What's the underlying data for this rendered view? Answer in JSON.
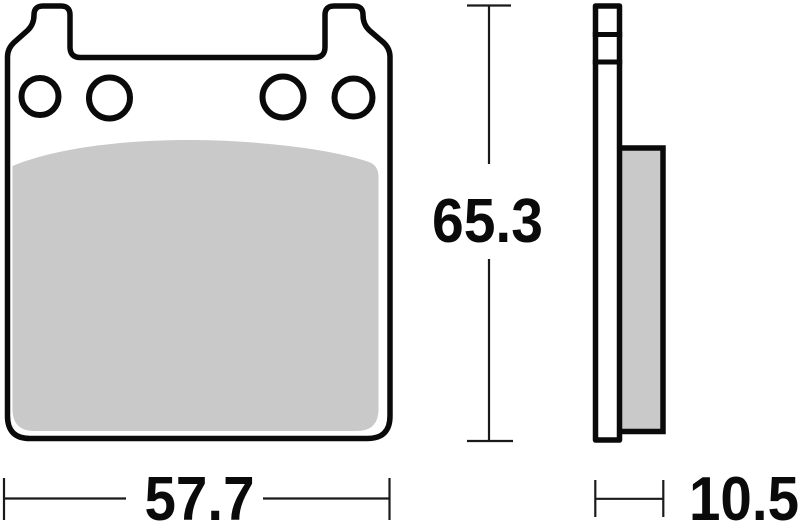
{
  "drawing": {
    "subject": "brake-pad-dimension-drawing",
    "colors": {
      "outline": "#0a0a0a",
      "friction_material": "#c9c9c9",
      "plate_fill": "#ffffff",
      "dimension_line": "#1a1a1a",
      "label_text": "#0a0a0a",
      "background": "#ffffff"
    },
    "dimensions": {
      "width": {
        "value": "57.7"
      },
      "height": {
        "value": "65.3"
      },
      "thickness": {
        "value": "10.5"
      }
    }
  }
}
